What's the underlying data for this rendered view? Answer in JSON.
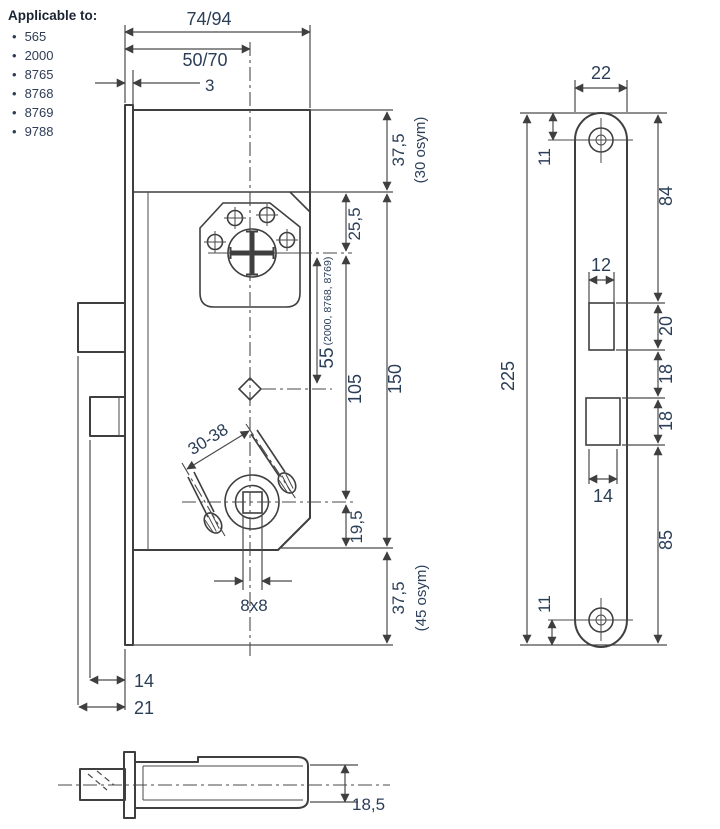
{
  "applicable": {
    "title": "Applicable to:",
    "items": [
      "565",
      "2000",
      "8765",
      "8768",
      "8769",
      "9788"
    ]
  },
  "front_view": {
    "dim_width": "74/94",
    "dim_backset": "50/70",
    "dim_plate_thickness": "3",
    "dim_top_margin": "37,5",
    "dim_top_margin_note": "(30 osym)",
    "dim_cyl_offset": "25,5",
    "dim_cyl_aux": "55",
    "dim_cyl_aux_note": "(2000, 8768, 8769)",
    "dim_cyl_spindle": "105",
    "dim_body_height": "150",
    "dim_spindle_bottom": "19,5",
    "dim_bottom_margin": "37,5",
    "dim_bottom_margin_note": "(45 osym)",
    "dim_screw_range": "30-38",
    "dim_spindle_square": "8x8",
    "dim_deadbolt_throw": "14",
    "dim_latch_throw": "21"
  },
  "faceplate_view": {
    "dim_width": "22",
    "dim_hole_top": "11",
    "dim_top_to_latch": "84",
    "dim_latch_width": "12",
    "dim_latch_height": "20",
    "dim_gap_upper": "18",
    "dim_gap_lower": "18",
    "dim_bolt_width": "14",
    "dim_bottom_section": "85",
    "dim_hole_bottom": "11",
    "dim_length": "225"
  },
  "side_view": {
    "dim_thickness": "18,5"
  }
}
